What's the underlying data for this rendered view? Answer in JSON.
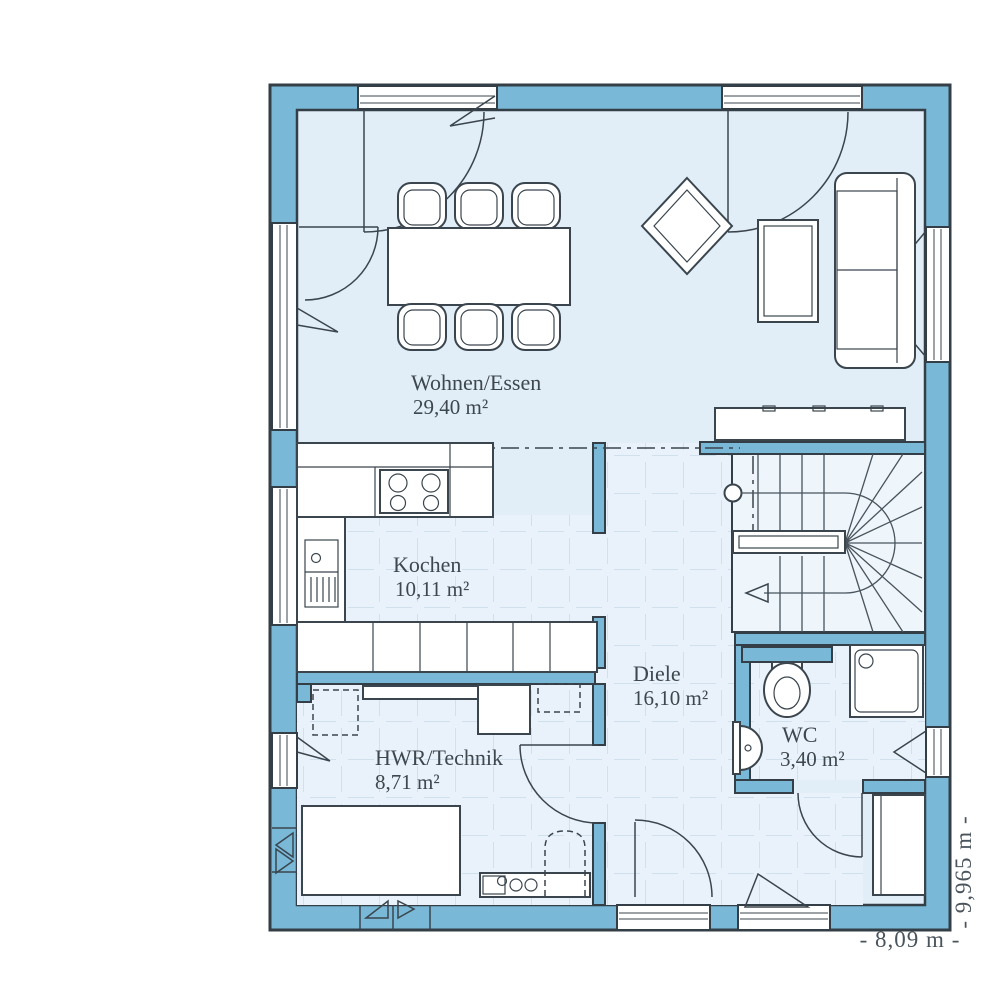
{
  "plan": {
    "rooms": [
      {
        "key": "wohnen",
        "name": "Wohnen/Essen",
        "area": "29,40 m²"
      },
      {
        "key": "kochen",
        "name": "Kochen",
        "area": "10,11 m²"
      },
      {
        "key": "diele",
        "name": "Diele",
        "area": "16,10 m²"
      },
      {
        "key": "hwr",
        "name": "HWR/Technik",
        "area": "8,71 m²"
      },
      {
        "key": "wc",
        "name": "WC",
        "area": "3,40 m²"
      }
    ],
    "dimensions": {
      "width_label": "- 8,09 m -",
      "height_label": "- 9,965 m -"
    },
    "colors": {
      "wall": "#79b9d7",
      "outline": "#333e46",
      "living_floor": "#e1edf7",
      "tile_floor": "#e9f2fa",
      "tile_grid": "#c2d5e3",
      "stair_floor": "#eef5fb",
      "label_text": "#3d474e"
    },
    "fixtures": [
      "dining-table",
      "dining-chairs",
      "area-rug",
      "coffee-table",
      "sofa",
      "sideboard",
      "kitchen-counter",
      "stove",
      "kitchen-sink",
      "kitchen-island",
      "staircase",
      "handrail",
      "toilet",
      "washbasin",
      "shower",
      "washer-dryer",
      "utility-unit",
      "boiler",
      "wardrobe-cabinet",
      "entrance-door",
      "terrace-doors",
      "windows",
      "vent-grilles"
    ]
  }
}
